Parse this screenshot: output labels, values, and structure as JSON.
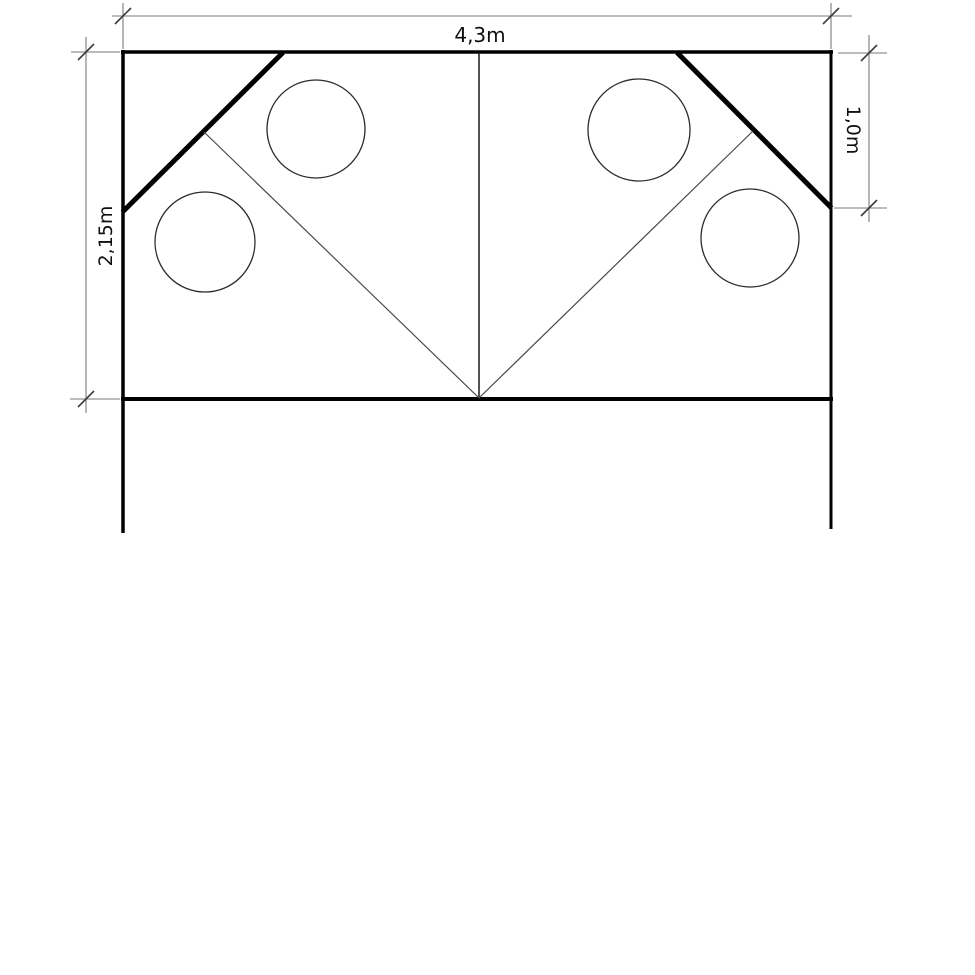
{
  "drawing": {
    "description": "technical-elevation-drawing",
    "colors": {
      "outline": "#000000",
      "thin_line": "#4a4a4a",
      "dimension_line": "#7a7a7a",
      "tick": "#3c3c3c",
      "text": "#101010",
      "background": "#ffffff"
    },
    "dimensions": {
      "top": {
        "label": "4,3m",
        "value_m": 4.3
      },
      "left": {
        "label": "2,15m",
        "value_m": 2.15
      },
      "right": {
        "label": "1,0m",
        "value_m": 1.0
      }
    },
    "circle_count": 4
  }
}
